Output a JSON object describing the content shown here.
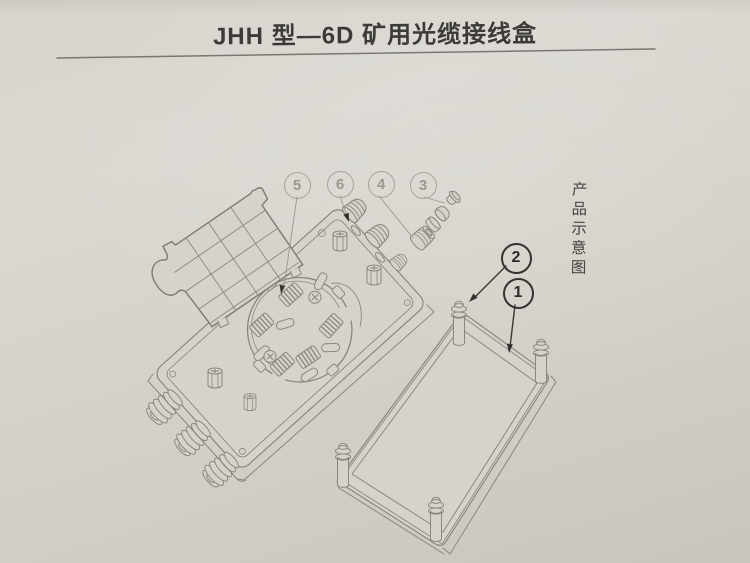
{
  "header": {
    "title": "JHH 型—6D 矿用光缆接线盒"
  },
  "side_caption": {
    "text": "产品示意图"
  },
  "diagram": {
    "kind": "exploded-isometric-line-drawing",
    "callouts": [
      {
        "label": "1"
      },
      {
        "label": "2"
      },
      {
        "label": "3"
      },
      {
        "label": "4"
      },
      {
        "label": "5"
      },
      {
        "label": "6"
      }
    ],
    "colors": {
      "paper": "#d7d3cc",
      "line": "#8b8780",
      "dark": "#34332f",
      "light_callout": "#a7a299"
    }
  }
}
